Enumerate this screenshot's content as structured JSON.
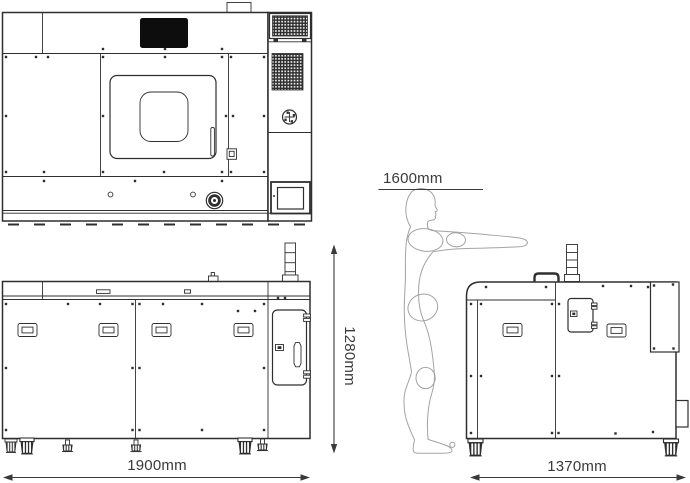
{
  "diagram": {
    "kind": "machine-dimension-drawing",
    "labels": {
      "front_width": "1900mm",
      "machine_height": "1280mm",
      "side_depth": "1370mm",
      "person_height": "1600mm"
    },
    "views": [
      {
        "id": "front-view",
        "position": "top-left"
      },
      {
        "id": "rear-view",
        "position": "bottom-left"
      },
      {
        "id": "side-view",
        "position": "bottom-right"
      },
      {
        "id": "human-figure",
        "position": "middle-right"
      }
    ],
    "icons": [
      "vent-grille-icon",
      "viewing-window-icon",
      "door-handle-icon",
      "rotary-knob-icon",
      "emergency-stop-icon",
      "touchscreen-icon",
      "signal-tower-icon",
      "panel-handle-icon",
      "hinge-icon",
      "connector-port-icon",
      "caster-icon",
      "leveling-foot-icon",
      "screw-dot-icon",
      "arrow-icon"
    ]
  },
  "colors": {
    "background": "#ffffff",
    "line": "#2f2f2f",
    "figure": "#a3a3a3",
    "dim": "#3a3a3a",
    "screen_fill": "#0d0d0d"
  }
}
